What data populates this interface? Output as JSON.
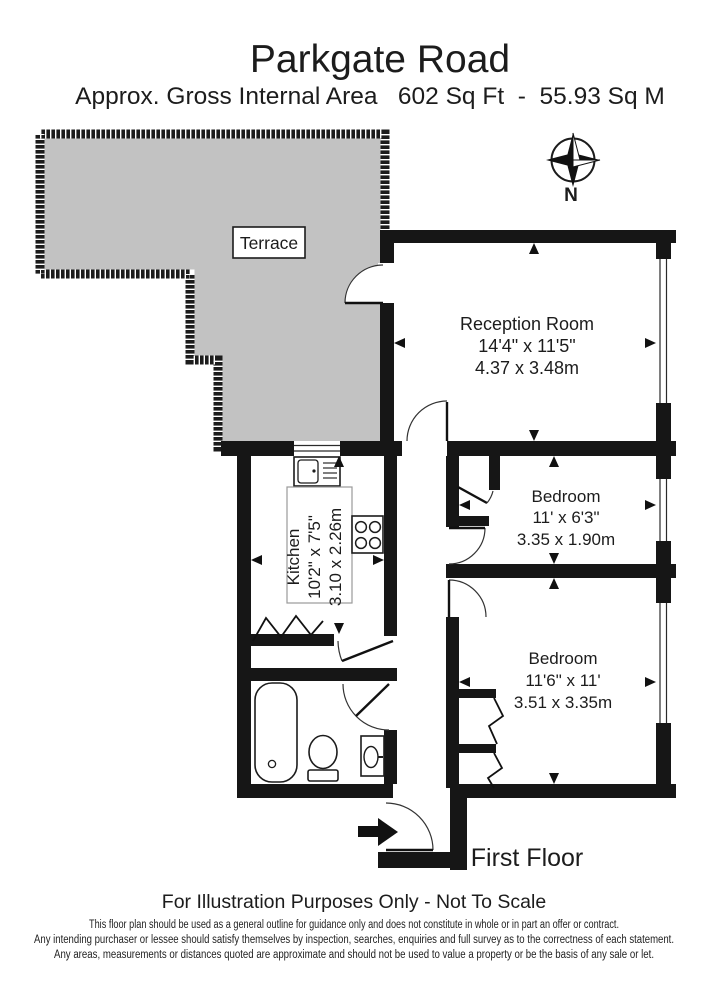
{
  "header": {
    "title": "Parkgate Road",
    "subtitle": "Approx. Gross Internal Area   602 Sq Ft  -  55.93 Sq M"
  },
  "compass": {
    "label": "N"
  },
  "terrace": {
    "label": "Terrace"
  },
  "rooms": {
    "reception": {
      "name": "Reception Room",
      "imperial": "14'4\" x 11'5\"",
      "metric": "4.37 x 3.48m"
    },
    "kitchen": {
      "name": "Kitchen",
      "imperial": "10'2\" x 7'5\"",
      "metric": "3.10 x 2.26m"
    },
    "bedroom1": {
      "name": "Bedroom",
      "imperial": "11' x 6'3\"",
      "metric": "3.35 x 1.90m"
    },
    "bedroom2": {
      "name": "Bedroom",
      "imperial": "11'6\" x 11'",
      "metric": "3.51 x 3.35m"
    }
  },
  "floor_label": "First Floor",
  "footer": {
    "notice": "For Illustration Purposes Only - Not To Scale",
    "disclaimer_lines": [
      "This floor plan should be used as a general outline for guidance only and does not constitute in whole or in part an offer or contract.",
      "Any intending purchaser or lessee should satisfy themselves by inspection, searches, enquiries and full survey as to the correctness of each statement.",
      "Any areas, measurements or distances quoted are approximate and should not be used to value a property or be the basis of any sale or let."
    ]
  },
  "colors": {
    "wall": "#161616",
    "terrace_fill": "#c2c2c2",
    "text": "#1c1c1c"
  }
}
